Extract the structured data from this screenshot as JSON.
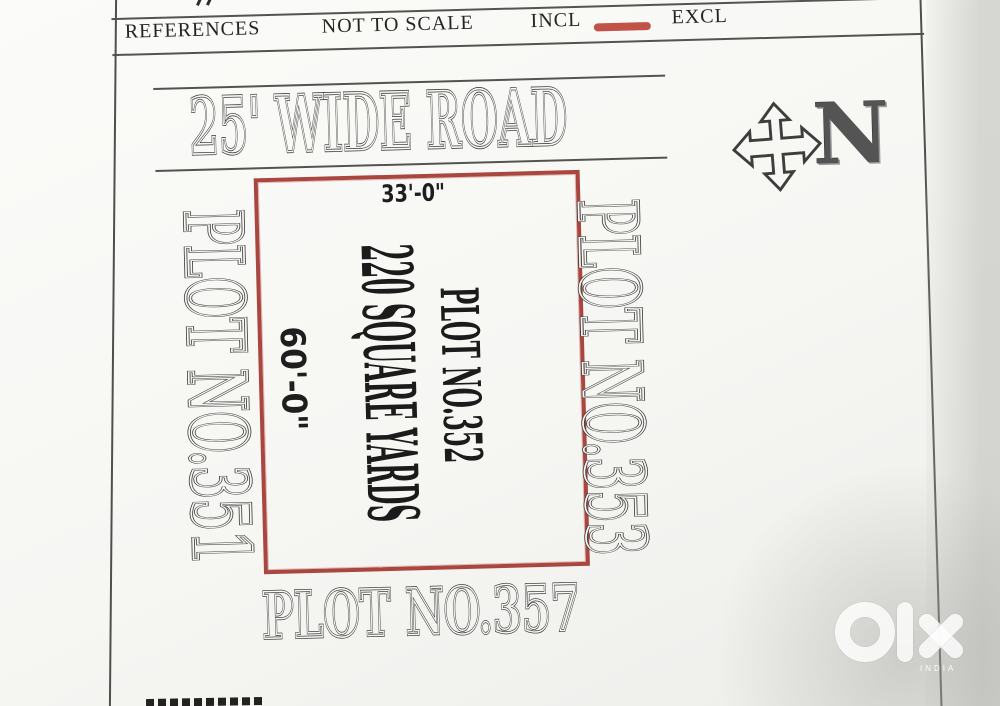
{
  "legend": {
    "references": "REFERENCES",
    "not_to_scale": "NOT TO SCALE",
    "incl": "INCL",
    "excl": "EXCL"
  },
  "road": {
    "label": "25' WIDE ROAD"
  },
  "plot": {
    "title": "PLOT NO.352",
    "area": "220 SQUARE YARDS",
    "top_dimension": "33'-0\"",
    "left_dimension": "60'-0\""
  },
  "adjacent_plots": {
    "left": "PLOT NO.351",
    "right": "PLOT NO.353",
    "bottom": "PLOT NO.357"
  },
  "compass": {
    "north": "N"
  },
  "watermark": {
    "brand": "olx",
    "caption": "INDIA"
  },
  "colors": {
    "plot_border": "#a94640",
    "incl_swatch": "#c05248",
    "ink_outline": "#3d3d3d",
    "paper": "#f8f8f5"
  }
}
